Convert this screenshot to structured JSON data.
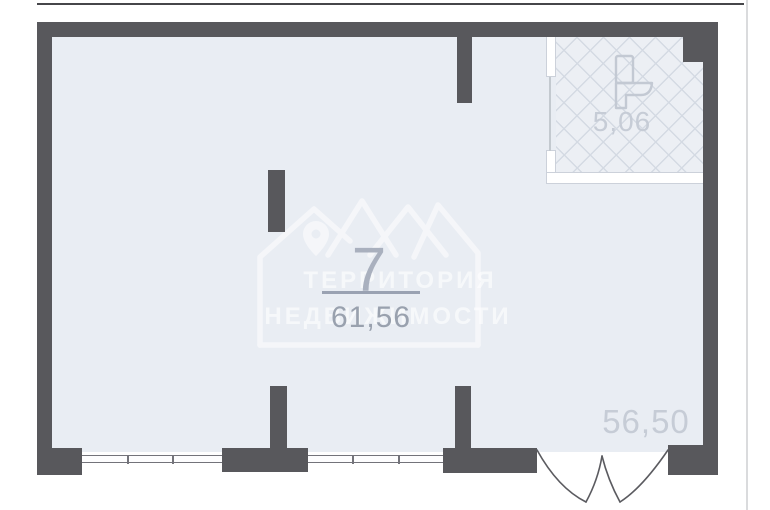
{
  "page": {
    "background": "#ffffff",
    "top_rule_color": "#46464a",
    "side_rule_color": "#dadbdd"
  },
  "floorplan": {
    "colors": {
      "wall": "#58585c",
      "floor": "#e9edf3",
      "bathroom_floor": "#eceff4",
      "hatch_line": "#d4dae3",
      "partition": "#ffffff",
      "partition_outline": "#ccd1da",
      "window_frame": "#73737a",
      "door_stroke": "#5b5b60",
      "fixture_stroke": "#c3c9d3",
      "label_primary": "#99a1ae",
      "label_light": "#c6ccd6"
    },
    "main_room": {
      "number": "7",
      "area": "61,56"
    },
    "bathroom": {
      "area": "5,06",
      "fixture_icon": "toilet-icon"
    },
    "total_area": "56,50",
    "features": [
      "windows-bottom-wall",
      "double-swing-entry-door-bottom-right",
      "tiled-bathroom-top-right"
    ]
  },
  "watermark": {
    "logo_icon": "house-mountains-pin-logo",
    "line1": "ТЕРРИТОРИЯ",
    "line2": "НЕДВИЖИМОСТИ",
    "color": "rgba(255,255,255,0.6)"
  }
}
